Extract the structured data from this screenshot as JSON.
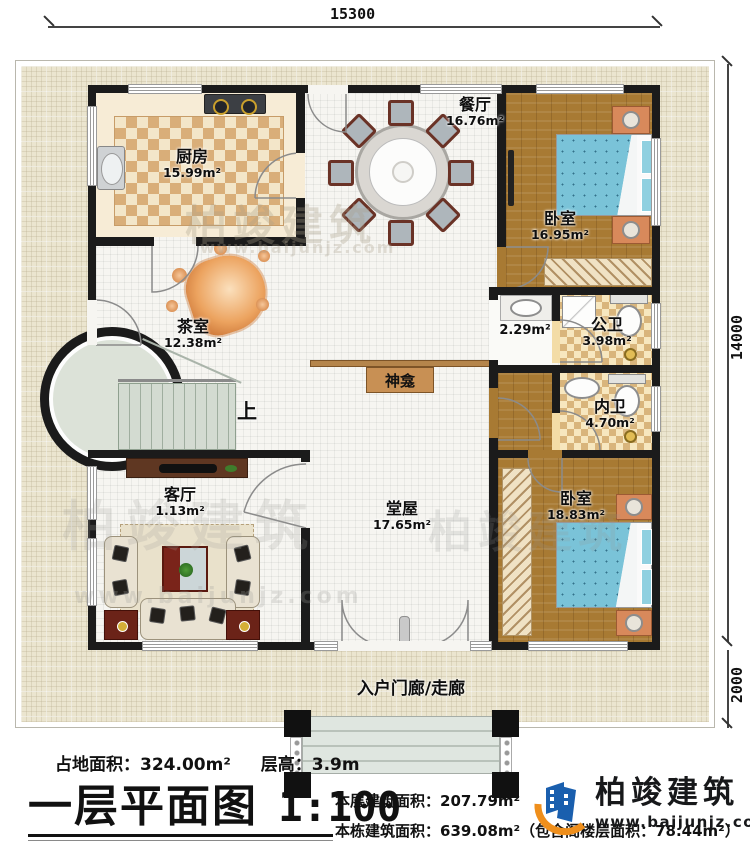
{
  "sheet": {
    "title": "一层平面图",
    "scale_label": "1:100"
  },
  "dimensions": {
    "top_width": "15300",
    "side_height": "14000",
    "porch_depth": "2000"
  },
  "rooms": {
    "kitchen": {
      "name": "厨房",
      "area": "15.99m²"
    },
    "dining": {
      "name": "餐厅",
      "area": "16.76m²"
    },
    "bedroom_top": {
      "name": "卧室",
      "area": "16.95m²"
    },
    "wash_area": {
      "area": "2.29m²"
    },
    "public_bath": {
      "name": "公卫",
      "area": "3.98m²"
    },
    "tea_room": {
      "name": "茶室",
      "area": "12.38m²"
    },
    "ensuite_bath": {
      "name": "内卫",
      "area": "4.70m²"
    },
    "living_room": {
      "name": "客厅",
      "area": "1.13m²"
    },
    "main_hall": {
      "name": "堂屋",
      "area": "17.65m²"
    },
    "bedroom_bottom": {
      "name": "卧室",
      "area": "18.83m²"
    }
  },
  "features": {
    "shrine": "神龛",
    "stairs_up": "上",
    "porch": "入户门廊/走廊"
  },
  "footer": {
    "land_area": "占地面积：324.00m²",
    "floor_height": "层高：3.9m",
    "floor_area": "本层建筑面积：207.79m²",
    "building_area": "本栋建筑面积：639.08m²（包含阁楼层面积：78.44m²）"
  },
  "brand": {
    "name": "柏竣建筑",
    "website": "www.baijunjz.com"
  },
  "watermark": {
    "name": "柏竣建筑",
    "website": "www.baijunjz.com"
  },
  "colors": {
    "wall": "#1b1b1b",
    "wood": "#a87a33",
    "bed": "#7ac3d8",
    "logo_blue": "#1a5fae",
    "logo_orange": "#ef8f1c",
    "plot": "#ebe5cf"
  }
}
